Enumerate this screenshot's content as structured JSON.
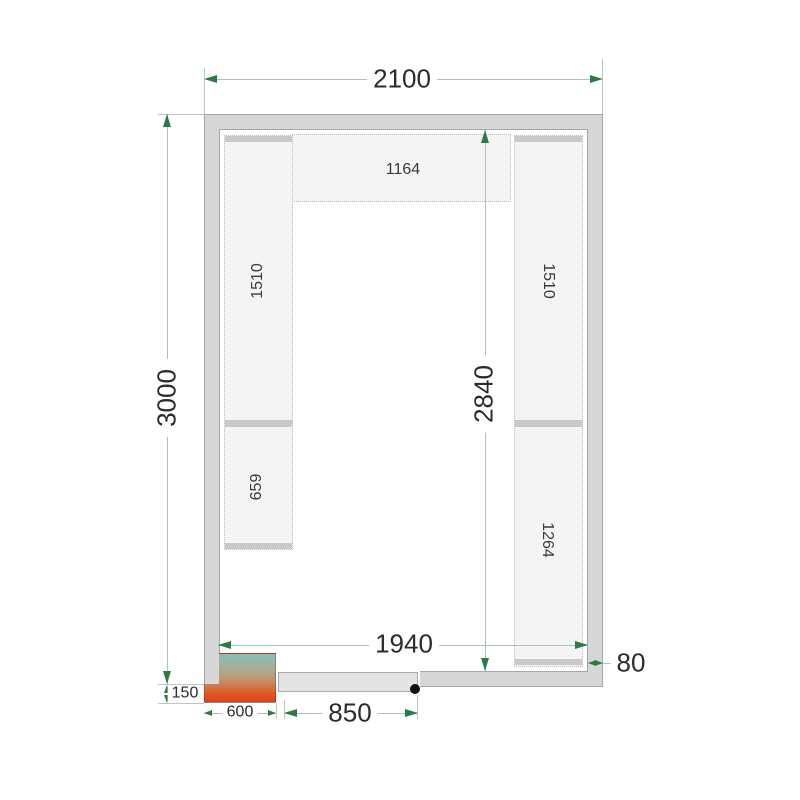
{
  "diagram": {
    "type": "cold-room floor plan, top view with shelving",
    "dims": {
      "top_width": "2100",
      "left_height": "3000",
      "inner_height": "2840",
      "inner_width": "1940",
      "wall_thickness": "80",
      "unit_offset": "150",
      "unit_width": "600",
      "door_width": "850"
    },
    "shelves": {
      "top": {
        "label": "1164"
      },
      "left_upper": {
        "label": "1510"
      },
      "left_lower": {
        "label": "659"
      },
      "right_upper": {
        "label": "1510"
      },
      "right_lower": {
        "label": "1264"
      }
    },
    "colors": {
      "wall_fill": "#d7d7d7",
      "wall_edge": "#a6a6a6",
      "shelf_fill": "#f4f4f4",
      "shelf_border": "#bdbdbd",
      "shelf_cap": "#c9c9c9",
      "dimension_line": "#aec3b2",
      "dimension_arrow": "#2c7a45",
      "dimension_text": "#2b2b2b",
      "unit_gradient_top": "#8abdb8",
      "unit_gradient_bottom": "#e0431a",
      "door_fill": "#e4e4e4",
      "hinge_dot": "#121212"
    }
  }
}
